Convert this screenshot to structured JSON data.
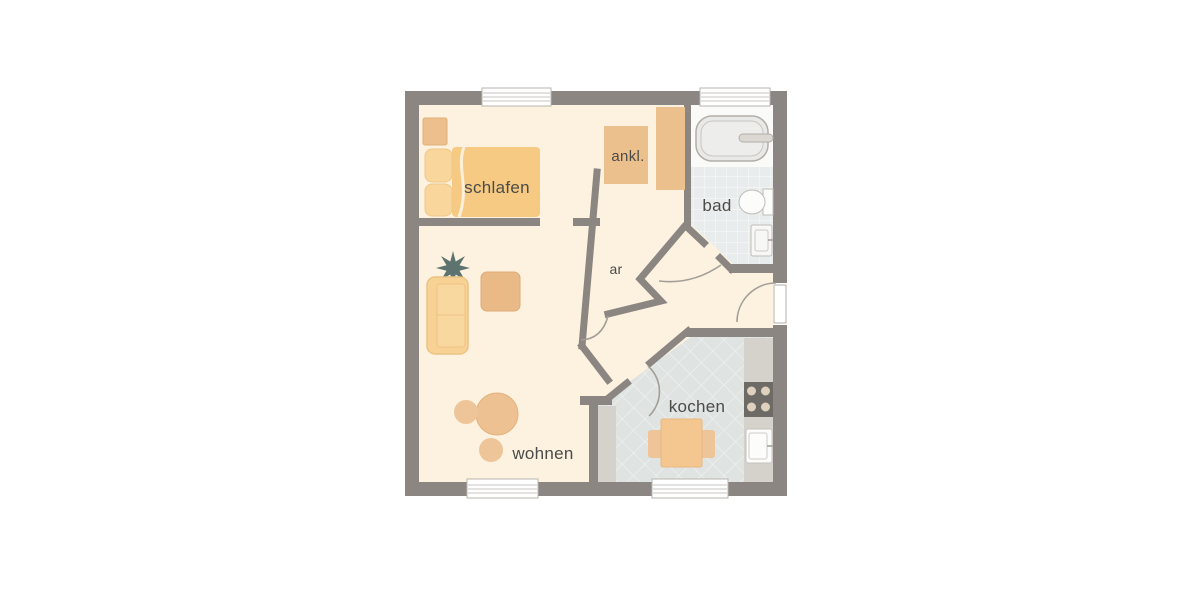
{
  "plan": {
    "type": "apartment-floor-plan",
    "language": "de"
  },
  "rooms": [
    {
      "id": "schlafen",
      "label": "schlafen"
    },
    {
      "id": "ankleide",
      "label": "ankl."
    },
    {
      "id": "bad",
      "label": "bad"
    },
    {
      "id": "abstellraum",
      "label": "ar"
    },
    {
      "id": "wohnen",
      "label": "wohnen"
    },
    {
      "id": "kochen",
      "label": "kochen"
    }
  ],
  "furniture": {
    "schlafen": [
      "double-bed",
      "pillows",
      "nightstand"
    ],
    "ankleide": [
      "wardrobe",
      "closet"
    ],
    "bad": [
      "bathtub",
      "toilet",
      "washbasin"
    ],
    "wohnen": [
      "plant",
      "sofa",
      "coffee-table",
      "round-table",
      "stools"
    ],
    "kochen": [
      "dining-table",
      "chairs",
      "stove",
      "kitchen-sink",
      "counter"
    ]
  },
  "openings": {
    "windows_top": 2,
    "windows_bottom": 2,
    "entrance_side": "right"
  },
  "colors": {
    "wall": "#8b8681",
    "floor": "#fcf2df",
    "bath_floor": "#fafaf8",
    "bath_tile": "#e9ecec",
    "kitchen_tile": "#dfe3e2",
    "counter": "#d5d2cc",
    "bed": "#f6ca82",
    "pillow": "#f9d79c",
    "wardrobe": "#ecc08d",
    "sofa": "#f8d294",
    "coffee_table": "#e9ba86",
    "round_table": "#edc191",
    "stool": "#edc598",
    "kitchen_table": "#f3c78f",
    "stove": "#6e6a65",
    "plant": "#5d7370",
    "fixture_white": "#fcfcfb",
    "door_arc": "#a39e98",
    "label_text": "#4b4b49",
    "window": "#ffffff",
    "background": "#ffffff"
  }
}
